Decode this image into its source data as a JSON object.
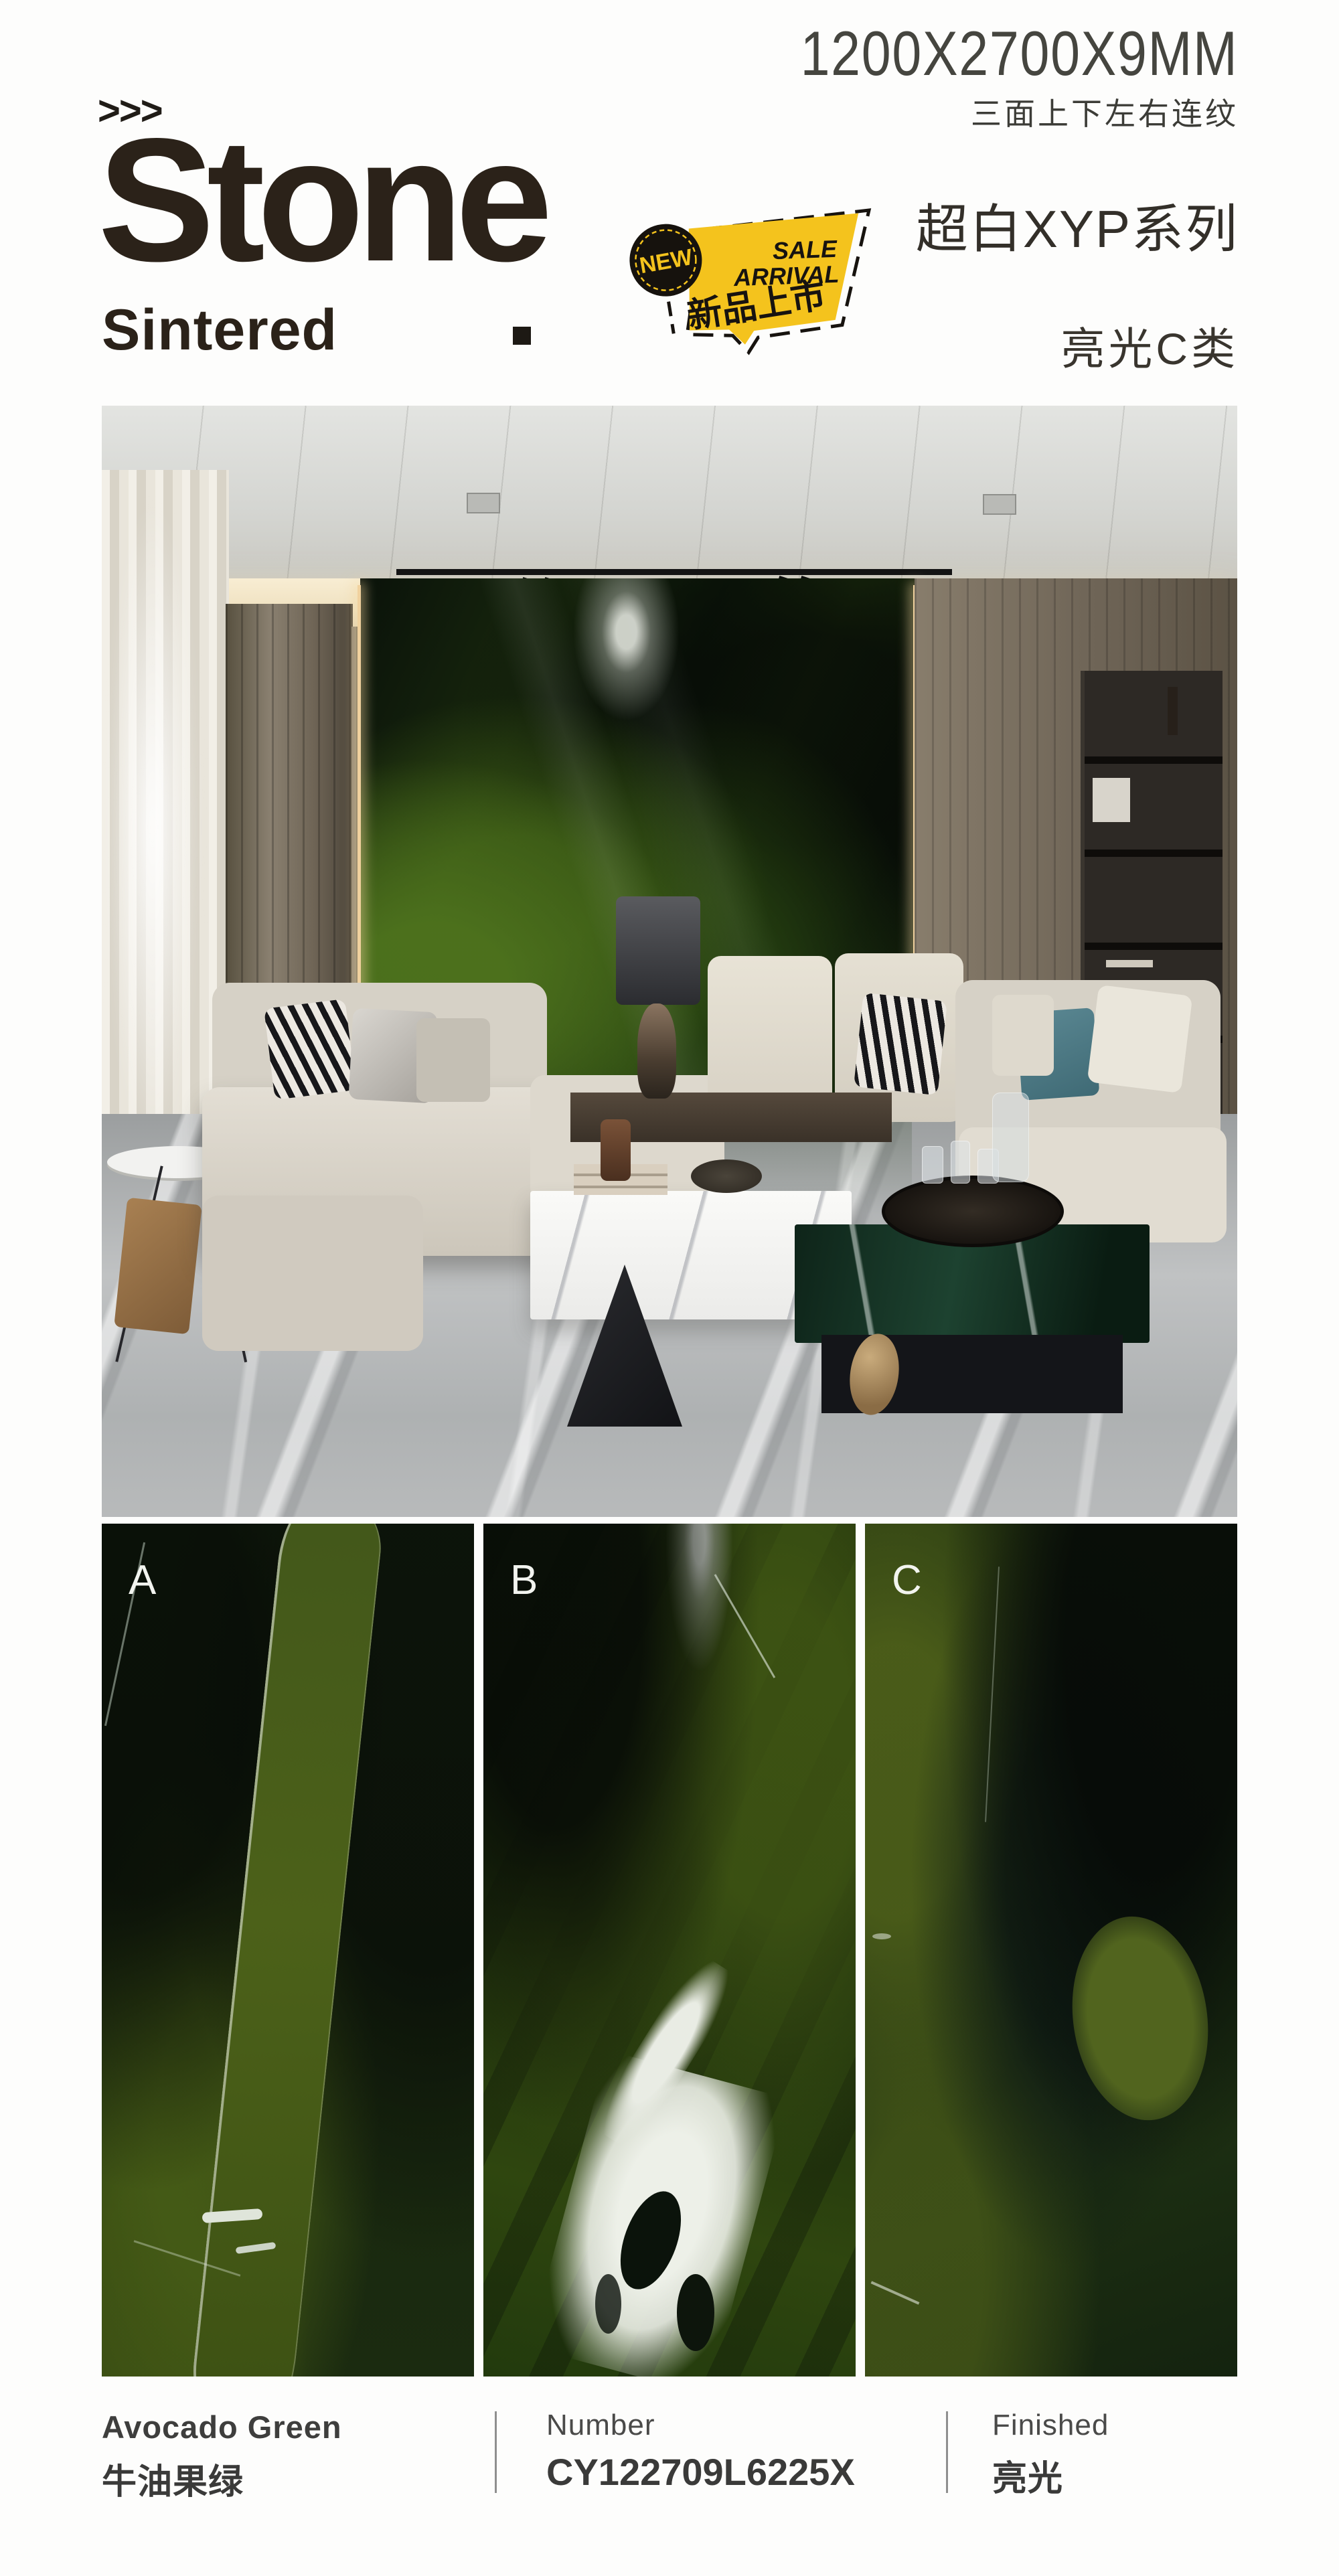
{
  "colors": {
    "badge_yellow": "#F4C31D",
    "badge_black": "#17130F",
    "title_ink": "#2B2219"
  },
  "header": {
    "size_label": "1200X2700X9MM",
    "continuity_label": "三面上下左右连纹",
    "arrows": ">>>",
    "title": "Stone",
    "subtitle": "Sintered",
    "series_label": "超白XYP系列",
    "gloss_label": "亮光C类"
  },
  "badge": {
    "new_label": "NEW",
    "sale": "SALE",
    "arrival": "ARRIVAL",
    "cn": "新品上市"
  },
  "panels": [
    {
      "label": "A"
    },
    {
      "label": "B"
    },
    {
      "label": "C"
    }
  ],
  "specs": {
    "color_en": "Avocado Green",
    "color_zh": "牛油果绿",
    "number_label": "Number",
    "number_value": "CY122709L6225X",
    "finished_label": "Finished",
    "finished_value": "亮光"
  }
}
